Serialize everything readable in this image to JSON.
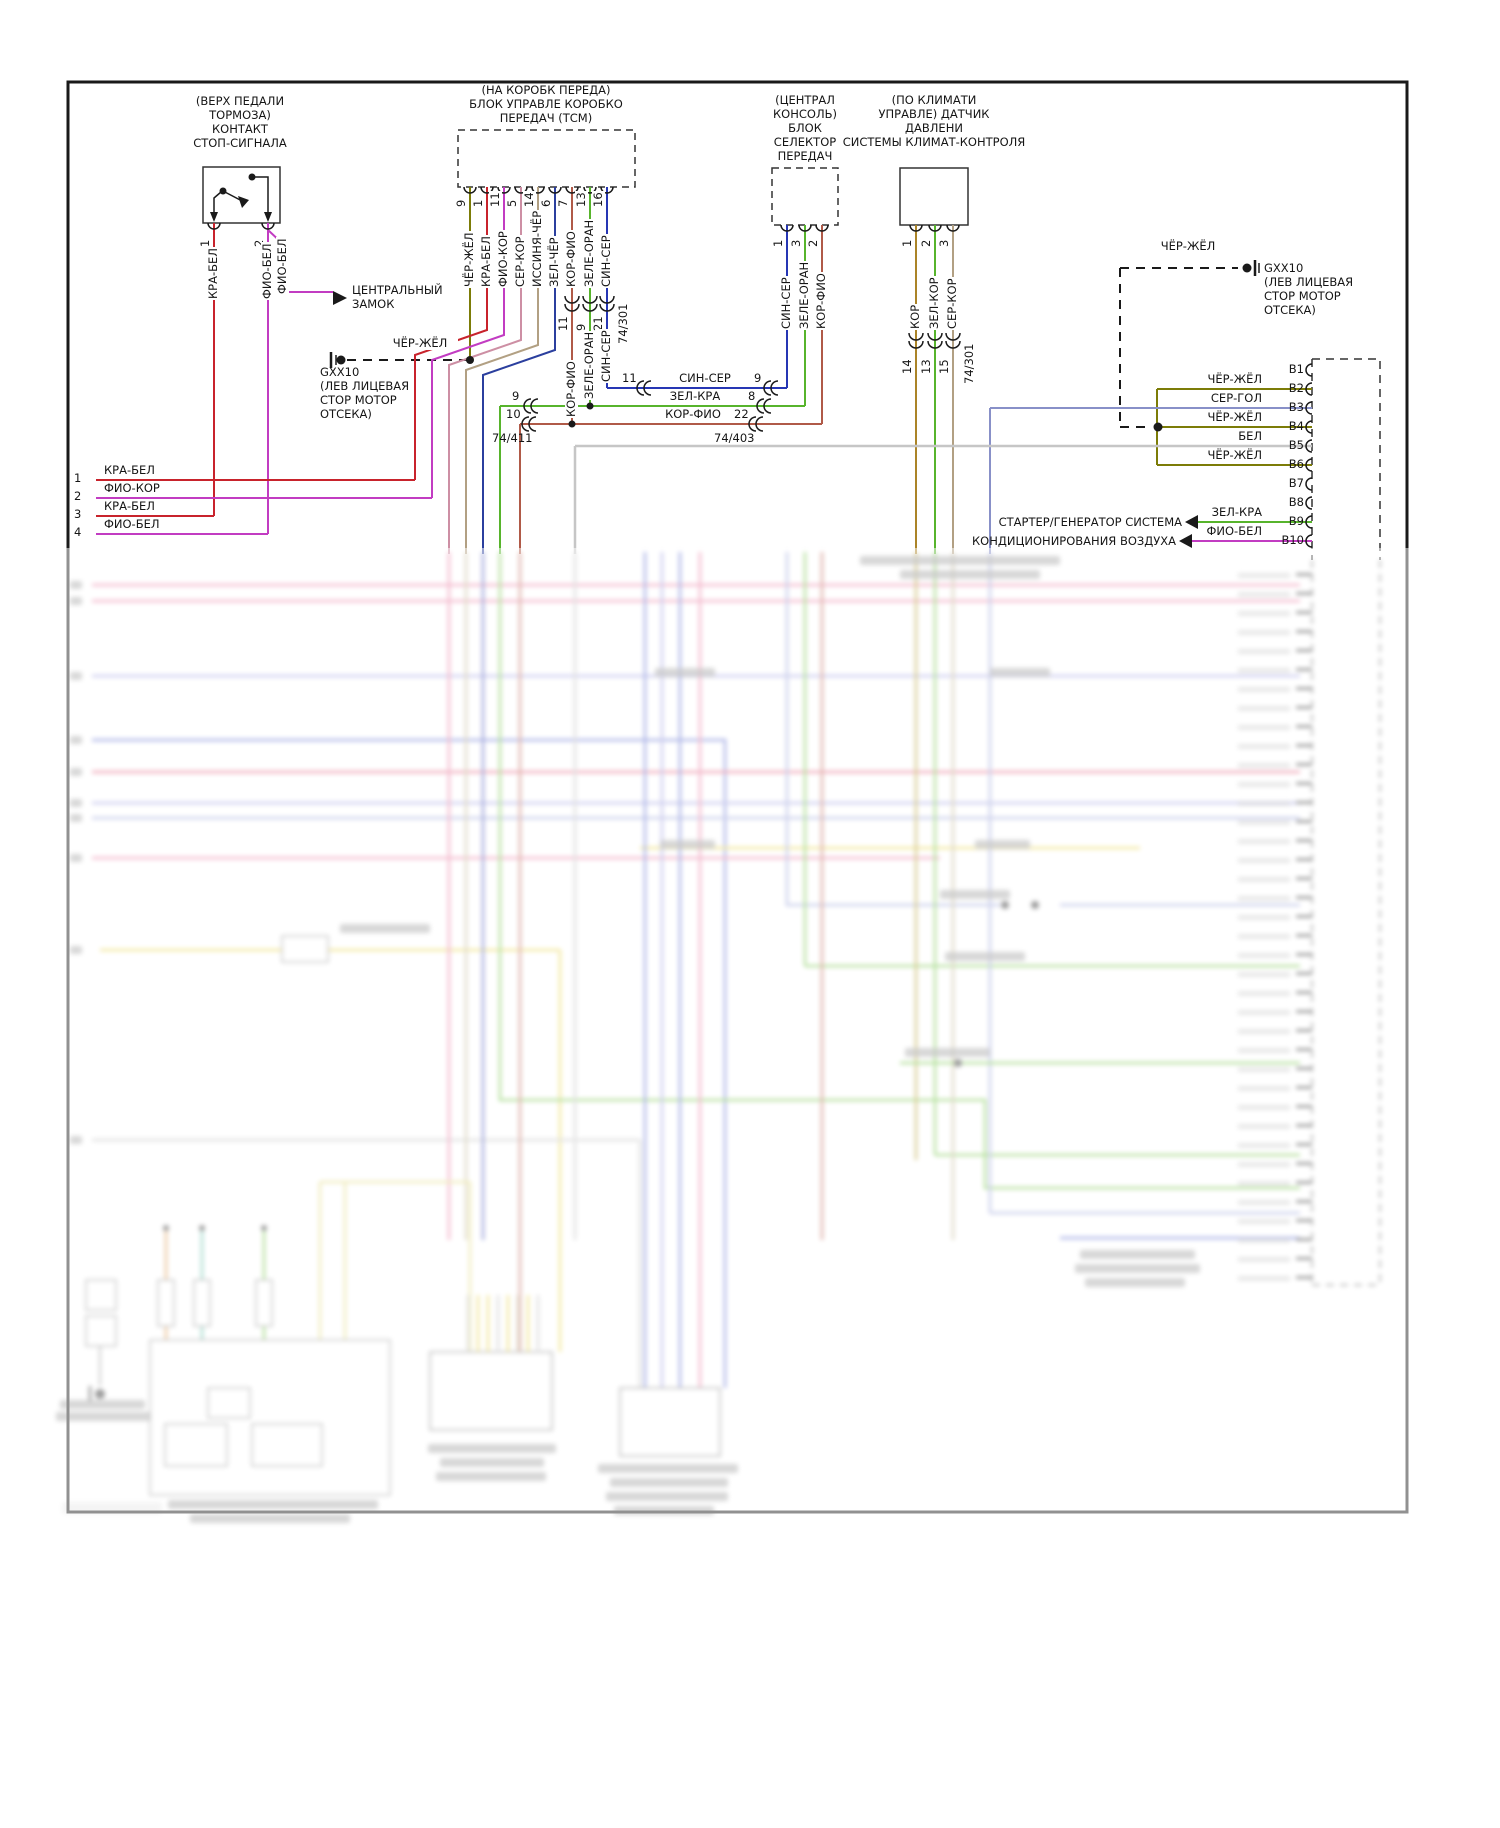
{
  "palette": {
    "red": "#c8232c",
    "magenta": "#c23cc2",
    "olive": "#7c7c08",
    "pink": "#cd8fa4",
    "tan": "#b2a083",
    "navy": "#2b3f9e",
    "brown": "#b05a48",
    "green": "#57b42c",
    "blue": "#2636b4",
    "grey_blue": "#8890c8",
    "grey": "#c6c6c6",
    "brown_olive": "#ab8428",
    "black": "#1a1a1a"
  },
  "brake_switch": {
    "lines": [
      "(ВЕРХ ПЕДАЛИ",
      "ТОРМОЗА)",
      "КОНТАКТ",
      "СТОП-СИГНАЛА"
    ],
    "pin1": "1",
    "pin1_wire": "КРА-БЕЛ",
    "pin2": "2",
    "pin2_wire": "ФИО-БЕЛ",
    "pin2_branch_wire": "ФИО-БЕЛ",
    "central_lock_lines": [
      "ЦЕНТРАЛЬНЫЙ",
      "ЗАМОК"
    ]
  },
  "ground_left": {
    "wire": "ЧЁР-ЖЁЛ",
    "lines": [
      "GXX10",
      "(ЛЕВ ЛИЦЕВАЯ",
      "СТОР МОТОР",
      "ОТСЕКА)"
    ]
  },
  "tcm": {
    "lines": [
      "(НА КОРОБК ПЕРЕДА)",
      "БЛОК УПРАВЛЕ КОРОБКО",
      "ПЕРЕДАЧ (ТСМ)"
    ],
    "pins": [
      {
        "n": "9",
        "w": "ЧЁР-ЖЁЛ"
      },
      {
        "n": "1",
        "w": "КРА-БЕЛ"
      },
      {
        "n": "11",
        "w": "ФИО-КОР"
      },
      {
        "n": "5",
        "w": "СЕР-КОР"
      },
      {
        "n": "14",
        "w": "ИССИНЯ-ЧЁР"
      },
      {
        "n": "6",
        "w": "ЗЕЛ-ЧЁР"
      },
      {
        "n": "7",
        "w": "КОР-ФИО"
      },
      {
        "n": "13",
        "w": "ЗЕЛЕ-ОРАН"
      },
      {
        "n": "16",
        "w": "СИН-СЕР"
      }
    ],
    "conn_nums": [
      "11",
      "9",
      "21"
    ],
    "conn_harness": "74/301",
    "lower_labels": [
      "КОР-ФИО",
      "ЗЕЛЕ-ОРАН",
      "СИН-СЕР"
    ]
  },
  "links": {
    "rows": [
      {
        "l": "11",
        "w": "СИН-СЕР",
        "r": "9"
      },
      {
        "l": "9",
        "w": "ЗЕЛ-КРА",
        "r": "8"
      },
      {
        "l": "10",
        "w": "КОР-ФИО",
        "r": "22"
      }
    ],
    "left_harness": "74/411",
    "right_harness": "74/403"
  },
  "left_rows": [
    {
      "n": "1",
      "w": "КРА-БЕЛ"
    },
    {
      "n": "2",
      "w": "ФИО-КОР"
    },
    {
      "n": "3",
      "w": "КРА-БЕЛ"
    },
    {
      "n": "4",
      "w": "ФИО-БЕЛ"
    }
  ],
  "console": {
    "lines": [
      "(ЦЕНТРАЛ",
      "КОНСОЛЬ)",
      "БЛОК",
      "СЕЛЕКТОР",
      "ПЕРЕДАЧ"
    ],
    "pins": [
      {
        "n": "1",
        "w": "СИН-СЕР"
      },
      {
        "n": "3",
        "w": "ЗЕЛЕ-ОРАН"
      },
      {
        "n": "2",
        "w": "КОР-ФИО"
      }
    ]
  },
  "climate": {
    "lines": [
      "(ПО КЛИМАТИ",
      "УПРАВЛЕ) ДАТЧИК",
      "ДАВЛЕНИ",
      "СИСТЕМЫ КЛИМАТ-КОНТРОЛЯ"
    ],
    "pins": [
      {
        "n": "1",
        "w": "КОР"
      },
      {
        "n": "2",
        "w": "ЗЕЛ-КОР"
      },
      {
        "n": "3",
        "w": "СЕР-КОР"
      }
    ],
    "conn_nums": [
      "14",
      "13",
      "15"
    ],
    "conn_harness": "74/301"
  },
  "ground_right": {
    "wire": "ЧЁР-ЖЁЛ",
    "lines": [
      "GXX10",
      "(ЛЕВ ЛИЦЕВАЯ",
      "СТОР МОТОР",
      "ОТСЕКА)"
    ]
  },
  "b_conn": {
    "pins": [
      {
        "id": "В1",
        "w": ""
      },
      {
        "id": "В2",
        "w": "ЧЁР-ЖЁЛ"
      },
      {
        "id": "В3",
        "w": "СЕР-ГОЛ"
      },
      {
        "id": "В4",
        "w": "ЧЁР-ЖЁЛ"
      },
      {
        "id": "В5",
        "w": "БЕЛ"
      },
      {
        "id": "В6",
        "w": "ЧЁР-ЖЁЛ"
      },
      {
        "id": "В7",
        "w": ""
      },
      {
        "id": "В8",
        "w": ""
      },
      {
        "id": "В9",
        "w": "ЗЕЛ-КРА"
      },
      {
        "id": "В10",
        "w": "ФИО-БЕЛ"
      }
    ]
  },
  "systems": [
    {
      "label": "СТАРТЕР/ГЕНЕРАТОР СИСТЕМА",
      "wire": "ЗЕЛ-КРА"
    },
    {
      "label": "КОНДИЦИОНИРОВАНИЯ ВОЗДУХА",
      "wire": "ФИО-БЕЛ"
    }
  ]
}
